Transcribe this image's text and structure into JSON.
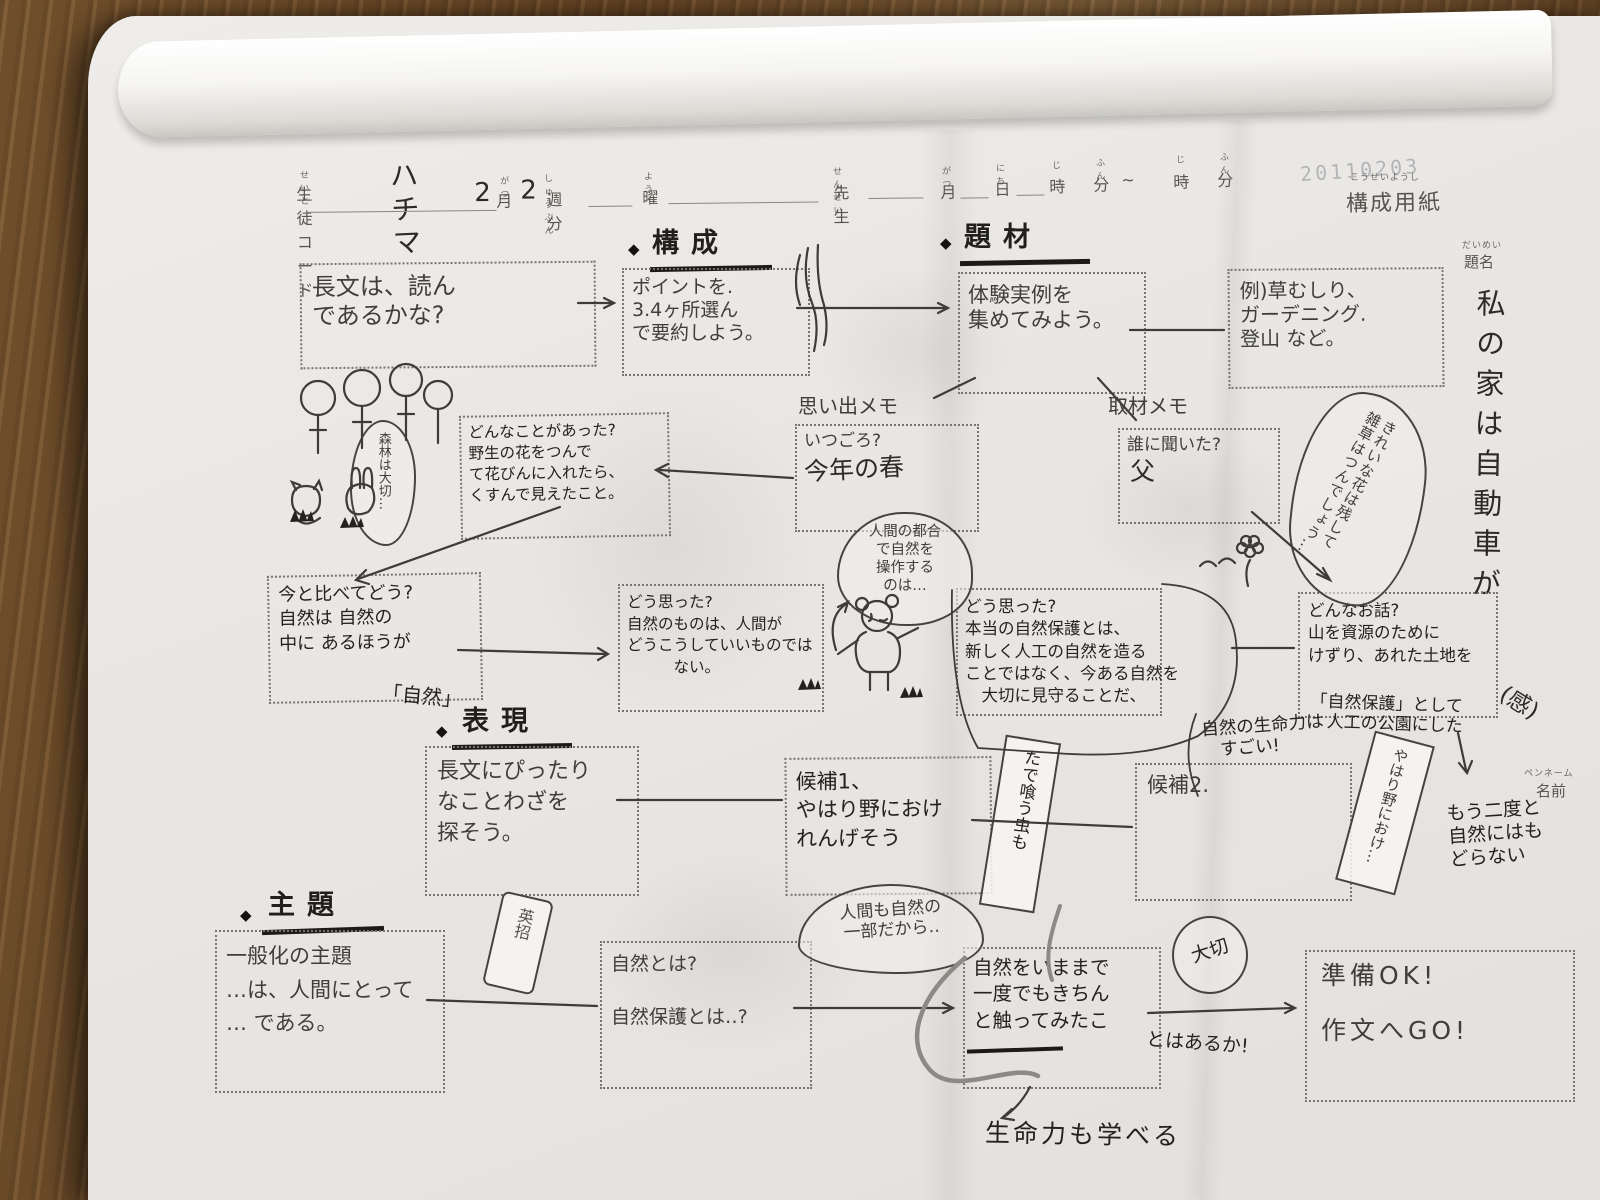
{
  "header": {
    "stamp": "20110203",
    "student": {
      "furigana": "せいと",
      "label": "生徒コード",
      "value": "ハチマ"
    },
    "week": {
      "month_value": "2",
      "month_label": "月",
      "month_furigana": "がつ",
      "week_value": "2",
      "week_label": "週分",
      "week_furigana": "しゅうぶん",
      "day_label": "曜",
      "day_furigana": "よう"
    },
    "teacher": {
      "furigana": "せんせい",
      "label": "先生"
    },
    "schedule": {
      "month_furigana": "がつ",
      "month": "月",
      "day_furigana": "にち",
      "day": "日",
      "hour_furigana": "じ",
      "hour": "時",
      "min_furigana": "ふん",
      "min": "分",
      "tilde": "~",
      "hour2_furigana": "じ",
      "hour2": "時",
      "min2_furigana": "ふん",
      "min2": "分"
    },
    "sheet": {
      "furigana": "こうせいようし",
      "label": "構成用紙"
    },
    "daimei": {
      "furigana": "だいめい",
      "label": "題名"
    },
    "name": {
      "small": "ペンネーム",
      "label": "名前"
    }
  },
  "essay_title": {
    "main": "私の家は自動車が",
    "suffix": "(感)"
  },
  "sections": {
    "kousei": {
      "bullet": "◆",
      "label": "構成"
    },
    "daizai": {
      "bullet": "◆",
      "label": "題材"
    },
    "hyougen": {
      "bullet": "◆",
      "label": "表現"
    },
    "shudai": {
      "bullet": "◆",
      "label": "主題"
    }
  },
  "boxes": {
    "intro": "長文は、読ん\nであるかな?",
    "points": "ポイントを.\n3.4ヶ所選ん\nで要約しよう。",
    "collect": "体験実例を\n集めてみよう。",
    "examples": "例)草むしり、\nガーデニング.\n登山 など。",
    "memo1": {
      "label": "思い出メモ",
      "q": "いつごろ?",
      "a": "今年の春"
    },
    "memo2": {
      "label": "取材メモ",
      "q": "誰に聞いた?",
      "a": "父"
    },
    "episode": "どんなことがあった?\n野生の花をつんで\nて花びんに入れたら、\nくすんで見えたこと。",
    "compare": "今と比べてどう?\n自然は 自然の\n中に あるほうが",
    "compare_tail": "「自然」",
    "thought1": "どう思った?\n自然のものは、人間が\nどうこうしていいものでは\n　　　ない。",
    "thought2": "どう思った?\n本当の自然保護とは、\n新しく人工の自然を造る\nことではなく、今ある自然を\n　大切に見守ることだ、",
    "story": "どんなお話?\n山を資源のために\nけずり、あれた土地を",
    "story_tail": "「自然保護」として\n　人工の公園にした",
    "lifeforce": "自然の生命力は\n　すごい!",
    "no_return": "もう二度と\n自然にはも\nどらない",
    "proverb": "長文にぴったり\nなことわざを\n探そう。",
    "kouho1": "候補1、\nやはり野におけ\nれんげそう",
    "kouho2": "候補2.",
    "shudai_box": "一般化の主題\n…は、人間にとって\n… である。",
    "shizen": "自然とは?\n\n自然保護とは‥?",
    "check": "自然をいままで\n一度でもきちん\nと触ってみたこ",
    "check_tail": "とはあるか!",
    "ready": "準備OK!\n\n作文へGO!",
    "learn": "生命力も学べる"
  },
  "bubbles": {
    "kirei": "きれいな花は残して\n雑草はつんでしょう…",
    "kuma": "人間の都合\nで自然を\n操作する\nのは…",
    "ningen": "人間も自然の\n一部だから‥",
    "shinrin": "森林は大切…",
    "taisetsu": "大切",
    "tade_slip": "たで喰う虫も",
    "yahari_slip": "やはり野におけ…",
    "tag": "英招"
  },
  "doodles": {
    "forest": "trees-and-animals-doodle",
    "bear": "bear-doodle",
    "flower": "flower-doodle",
    "willow": "willow-scribble",
    "grass": "grass-tufts"
  }
}
